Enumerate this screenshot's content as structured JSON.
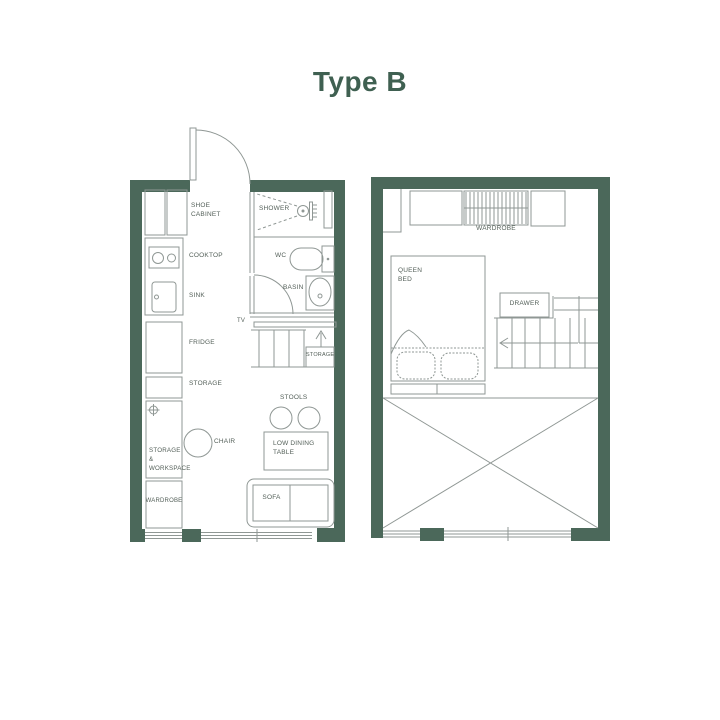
{
  "title": "Type B",
  "colors": {
    "wall": "#4b685a",
    "line": "#8f9794",
    "label": "#535f58",
    "title": "#3f6051"
  },
  "plans": {
    "lower": {
      "labels": {
        "shoe_cabinet": "SHOE\nCABINET",
        "cooktop": "COOKTOP",
        "sink": "SINK",
        "fridge": "FRIDGE",
        "storage": "STORAGE",
        "shower": "SHOWER",
        "wc": "WC",
        "basin": "BASIN",
        "tv": "TV",
        "stair_storage": "STORAGE",
        "stools": "STOOLS",
        "chair": "CHAIR",
        "low_dining_table": "LOW DINING\nTABLE",
        "sofa": "SOFA",
        "storage_workspace": "STORAGE\n&\nWORKSPACE",
        "wardrobe": "WARDROBE"
      }
    },
    "upper": {
      "labels": {
        "wardrobe": "WARDROBE",
        "queen_bed": "QUEEN\nBED",
        "drawer": "DRAWER"
      }
    }
  }
}
